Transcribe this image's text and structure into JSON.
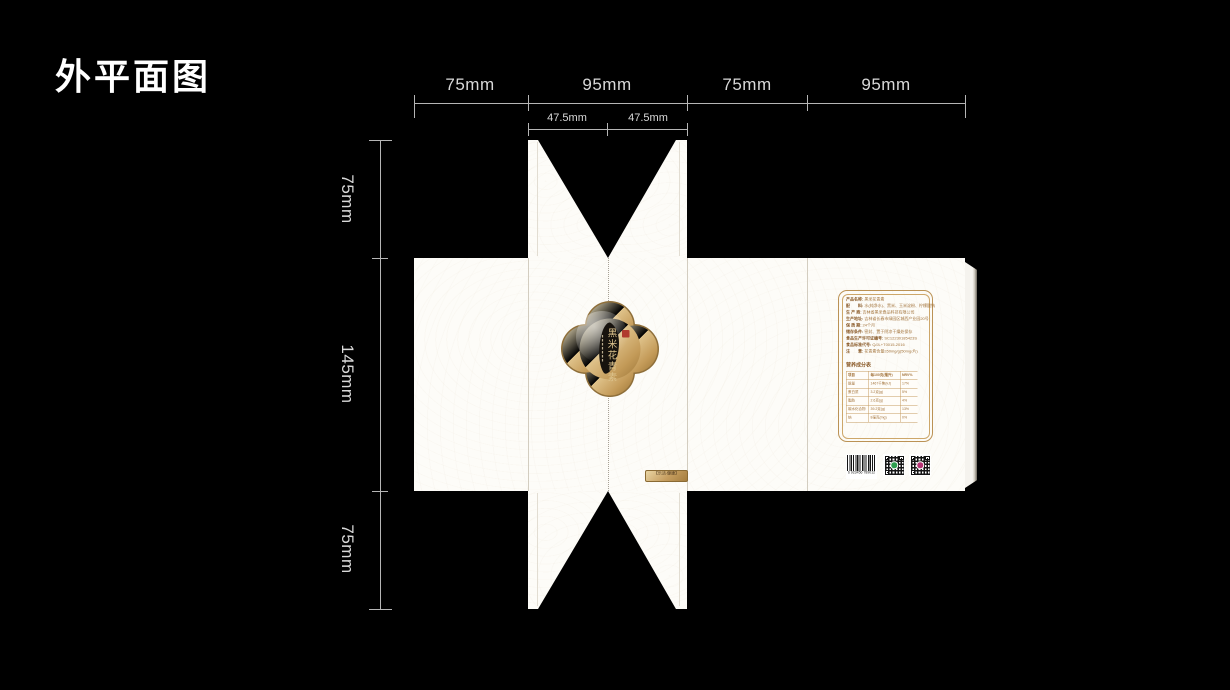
{
  "title": "外平面图",
  "dims": {
    "top": [
      "75mm",
      "95mm",
      "75mm",
      "95mm"
    ],
    "top_sub": [
      "47.5mm",
      "47.5mm"
    ],
    "left": [
      "75mm",
      "145mm",
      "75mm"
    ]
  },
  "badge": {
    "title": "黑米花青素",
    "seal_color": "#b03a2e",
    "gold_light": "#f6e9c3",
    "gold_dark": "#9a7436"
  },
  "plaque": {
    "text": "【乐活·健康】"
  },
  "info": {
    "fields": [
      {
        "label": "产品名称:",
        "value": "黑米花青素"
      },
      {
        "label": "配　　料:",
        "value": "水(纯净水)、黑米、玉米淀粉、柠檬酸钠"
      },
      {
        "label": "生 产 商:",
        "value": "吉林省黑米食品科技有限公司"
      },
      {
        "label": "生产地址:",
        "value": "吉林省长春市绿园区城西产业园20号"
      },
      {
        "label": "保 质 期:",
        "value": "24个月"
      },
      {
        "label": "储存条件:",
        "value": "密封、置于阴凉干燥处保存"
      },
      {
        "label": "食品生产许可证编号:",
        "value": "SC12230185423S"
      },
      {
        "label": "食品标准代号:",
        "value": "Q/JL+T0015-2016"
      },
      {
        "label": "注　　意:",
        "value": "花青素含量≥50mg/g(50mg/片)"
      }
    ],
    "nutrition": {
      "title": "营养成分表",
      "header": [
        "项目",
        "每100克(毫升)",
        "NRV%"
      ],
      "rows": [
        [
          "能量",
          "1467千焦(kJ)",
          "17%"
        ],
        [
          "蛋白质",
          "3.2克(g)",
          "5%"
        ],
        [
          "脂肪",
          "2.6克(g)",
          "4%"
        ],
        [
          "碳水化合物",
          "39.2克(g)",
          "13%"
        ],
        [
          "钠",
          "8毫克(mg)",
          "0%"
        ]
      ]
    }
  },
  "barcode": {
    "digits": "6 923456 789012"
  },
  "qr": {
    "left_center_color": "#2e9e4f",
    "right_center_color": "#b53374"
  },
  "colors": {
    "background": "#000000",
    "dimension_line": "#b5b5b5",
    "paper": "#fdfcf8",
    "frame_gold": "#bb9255",
    "info_text": "#a3743c"
  }
}
